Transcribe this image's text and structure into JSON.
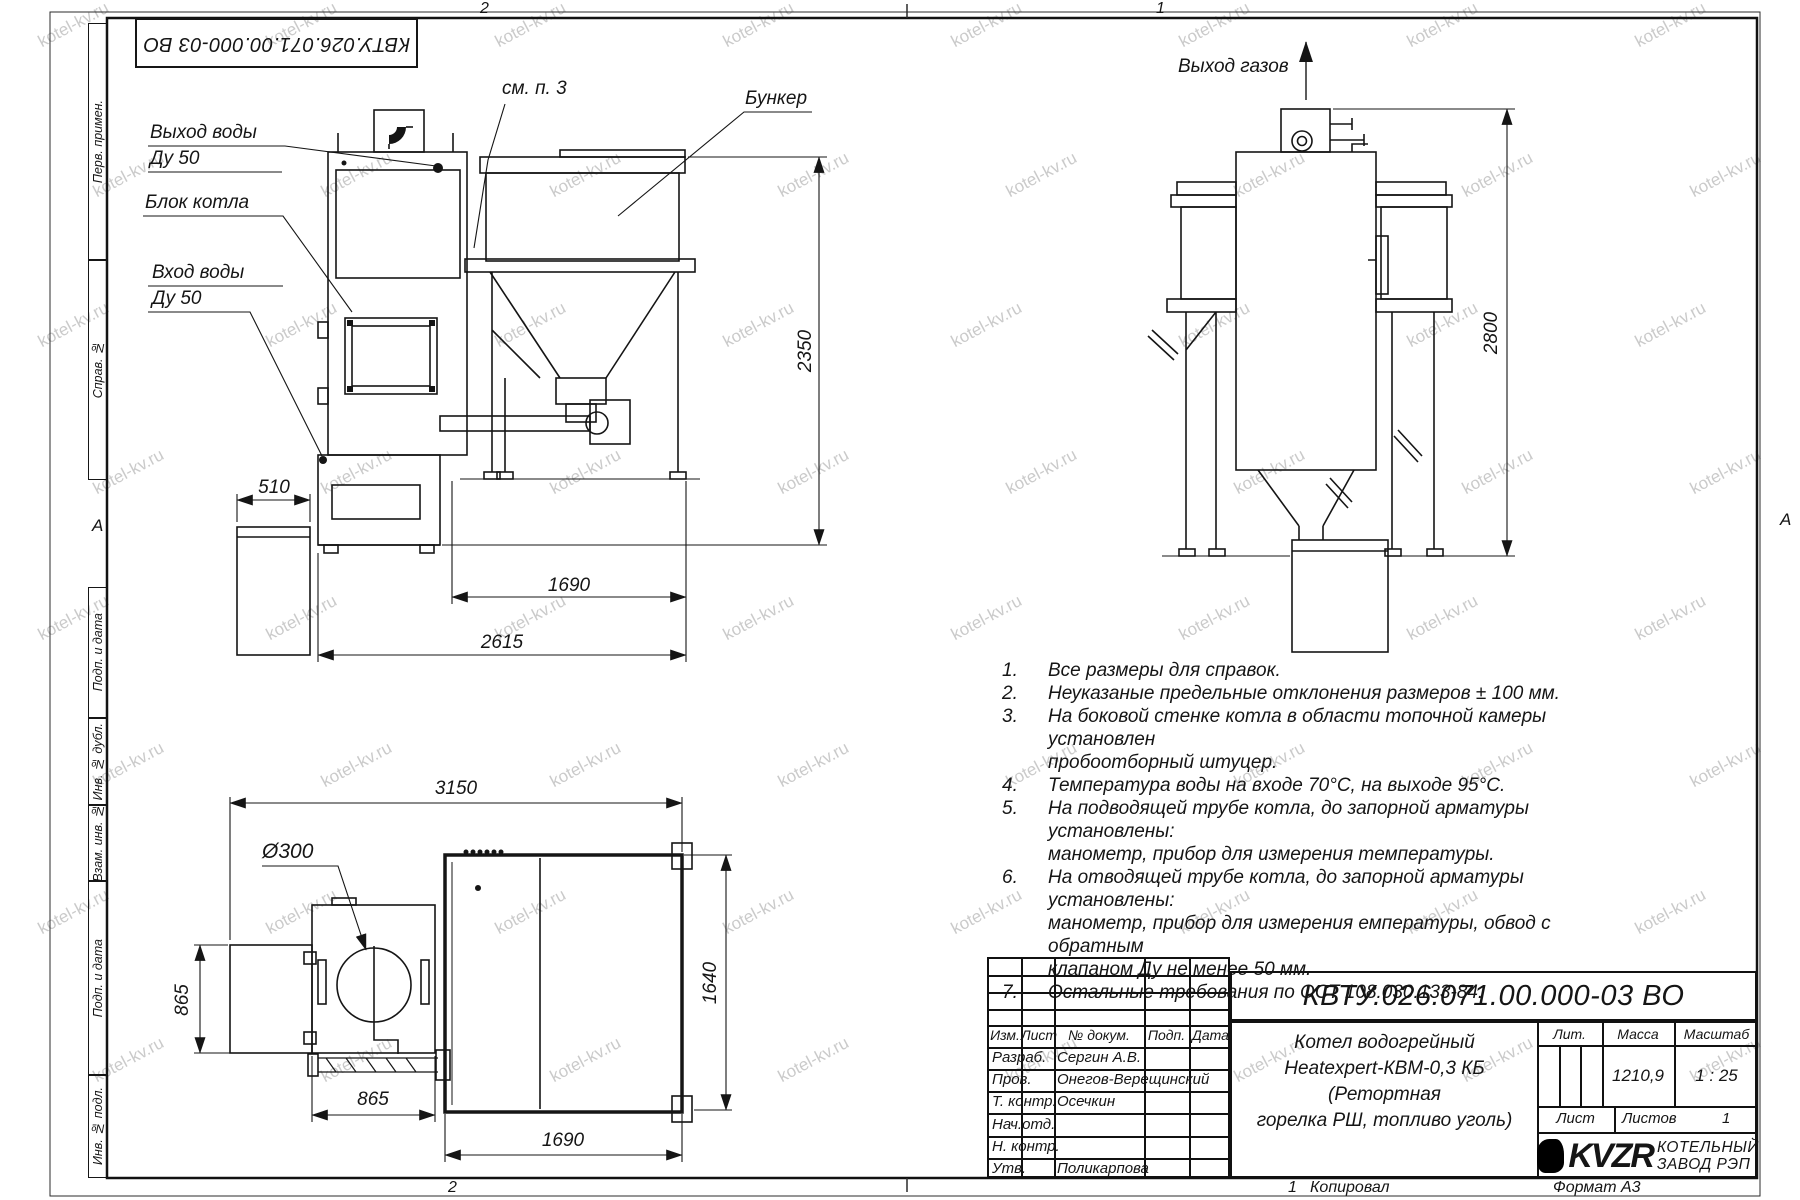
{
  "watermark": "kotel-kv.ru",
  "zones": {
    "top_left": "2",
    "top_right": "1",
    "bottom_left": "2",
    "bottom_mid": "1",
    "section_a_left": "А",
    "section_a_right": "А"
  },
  "top_doc_number": "КВТУ.026.071.00.000-03 ВО",
  "side_labels": [
    "Перв. примен.",
    "Справ. №",
    "Подп. и дата",
    "Инв. № дубл.",
    "Взам. инв. №",
    "Подп. и дата",
    "Инв. № подл."
  ],
  "front_view": {
    "label_water_out": "Выход воды",
    "label_water_out_dn": "Ду 50",
    "label_boiler_block": "Блок котла",
    "label_water_in": "Вход воды",
    "label_water_in_dn": "Ду 50",
    "label_see_note": "см. п. 3",
    "label_bunker": "Бункер",
    "dim_510": "510",
    "dim_1690": "1690",
    "dim_2615": "2615",
    "dim_2350": "2350"
  },
  "right_view": {
    "label_gas_out": "Выход газов",
    "dim_2800": "2800"
  },
  "plan_view": {
    "dim_3150": "3150",
    "dim_d300": "Ø300",
    "dim_865_left": "865",
    "dim_865_bottom": "865",
    "dim_1690": "1690",
    "dim_1640": "1640"
  },
  "notes": {
    "items": [
      {
        "num": "1.",
        "text": "Все размеры для справок."
      },
      {
        "num": "2.",
        "text": "Неуказаные предельные отклонения размеров ± 100 мм."
      },
      {
        "num": "3.",
        "text": "На боковой стенке котла в области топочной камеры установлен\nпробоотборный штуцер."
      },
      {
        "num": "4.",
        "text": "Температура воды на входе 70°С, на выходе 95°С."
      },
      {
        "num": "5.",
        "text": "На подводящей трубе котла, до запорной арматуры установлены:\nманометр, прибор для измерения температуры."
      },
      {
        "num": "6.",
        "text": "На отводящей трубе котла, до запорной арматуры установлены:\nманометр, прибор для измерения емпературы, обвод с обратным\nклапаном Ду не менее 50 мм."
      },
      {
        "num": "7.",
        "text": "Остальные требования по ОСТ 108.030.133-84."
      }
    ]
  },
  "titleblock": {
    "doc_number": "КВТУ.026.071.00.000-03 ВО",
    "product_name": "Котел водогрейный\nHeatexpert-КВМ-0,3 КБ (Ретортная\nгорелка РШ, топливо уголь)",
    "header_cols": {
      "izm": "Изм.",
      "list": "Лист",
      "doc": "№ докум.",
      "podp": "Подп.",
      "data": "Дата"
    },
    "rows": [
      {
        "role": "Разраб.",
        "name": "Сергин А.В."
      },
      {
        "role": "Пров.",
        "name": "Онегов-Верещинский"
      },
      {
        "role": "Т. контр.",
        "name": "Осечкин"
      },
      {
        "role": "Нач.отд.",
        "name": ""
      },
      {
        "role": "Н. контр.",
        "name": ""
      },
      {
        "role": "Утв.",
        "name": "Поликарпова"
      }
    ],
    "lit_label": "Лит.",
    "mass_label": "Масса",
    "scale_label": "Масштаб",
    "mass_value": "1210,9",
    "scale_value": "1 : 25",
    "sheet_label": "Лист",
    "sheets_label": "Листов",
    "sheets_value": "1",
    "company_logo": "KVZR",
    "company_line1": "КОТЕЛЬНЫЙ",
    "company_line2": "ЗАВОД РЭП",
    "copied_num": "1",
    "copied_label": "Копировал",
    "format_label": "Формат А3"
  }
}
